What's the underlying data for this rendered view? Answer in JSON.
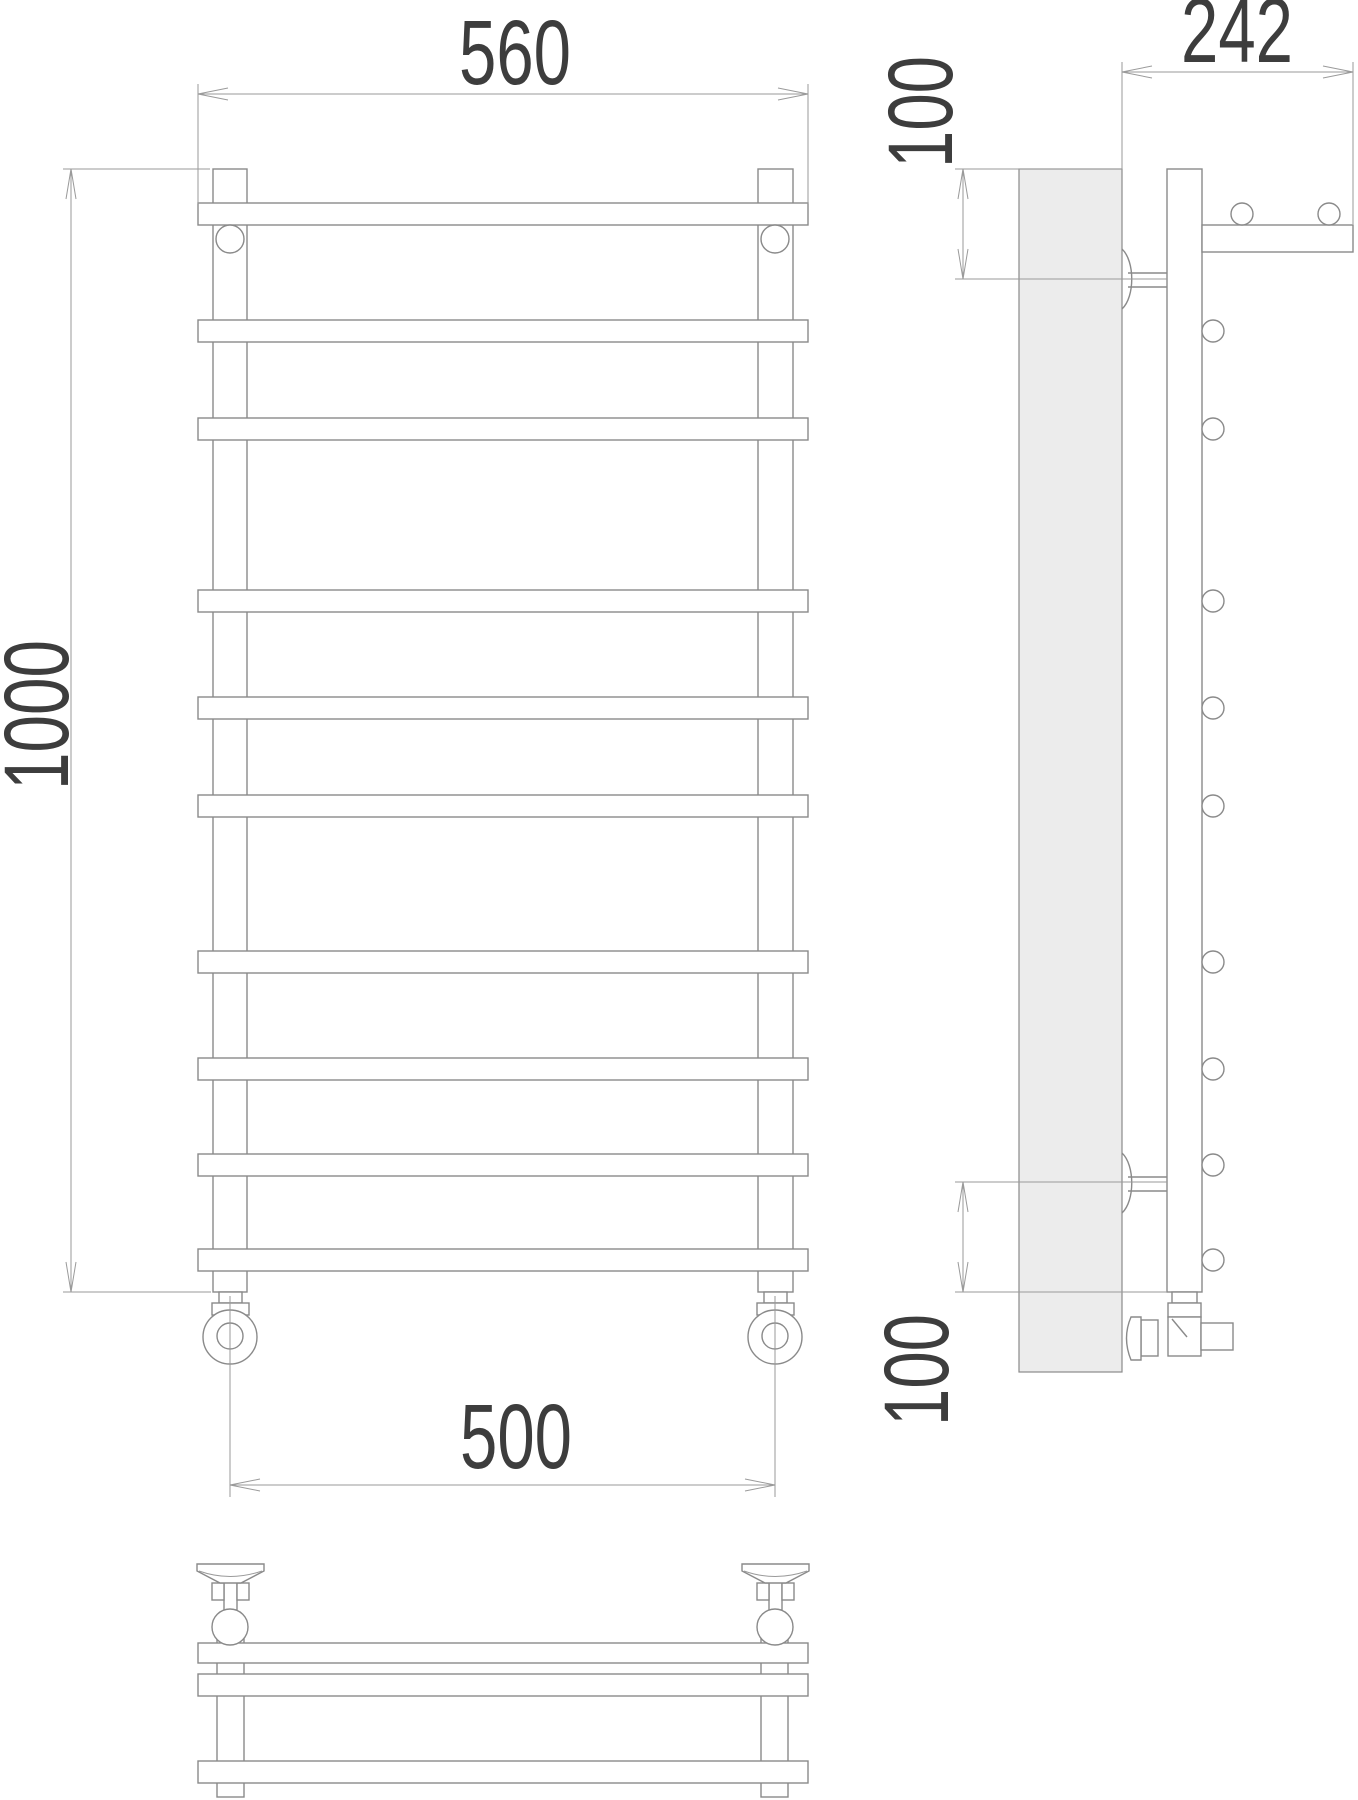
{
  "drawing": {
    "type": "technical-drawing-towel-rail-three-views",
    "dimensions": {
      "overall_width_top": "560",
      "overall_height": "1000",
      "shelf_depth": "242",
      "top_offset": "100",
      "bottom_offset": "100",
      "connection_spacing_bottom": "500"
    },
    "colors": {
      "line": "#8a8a8a",
      "dim": "#9a9a9a",
      "text": "#3d3d3d",
      "wall_fill": "#ececec",
      "shape_fill": "#ffffff"
    }
  }
}
